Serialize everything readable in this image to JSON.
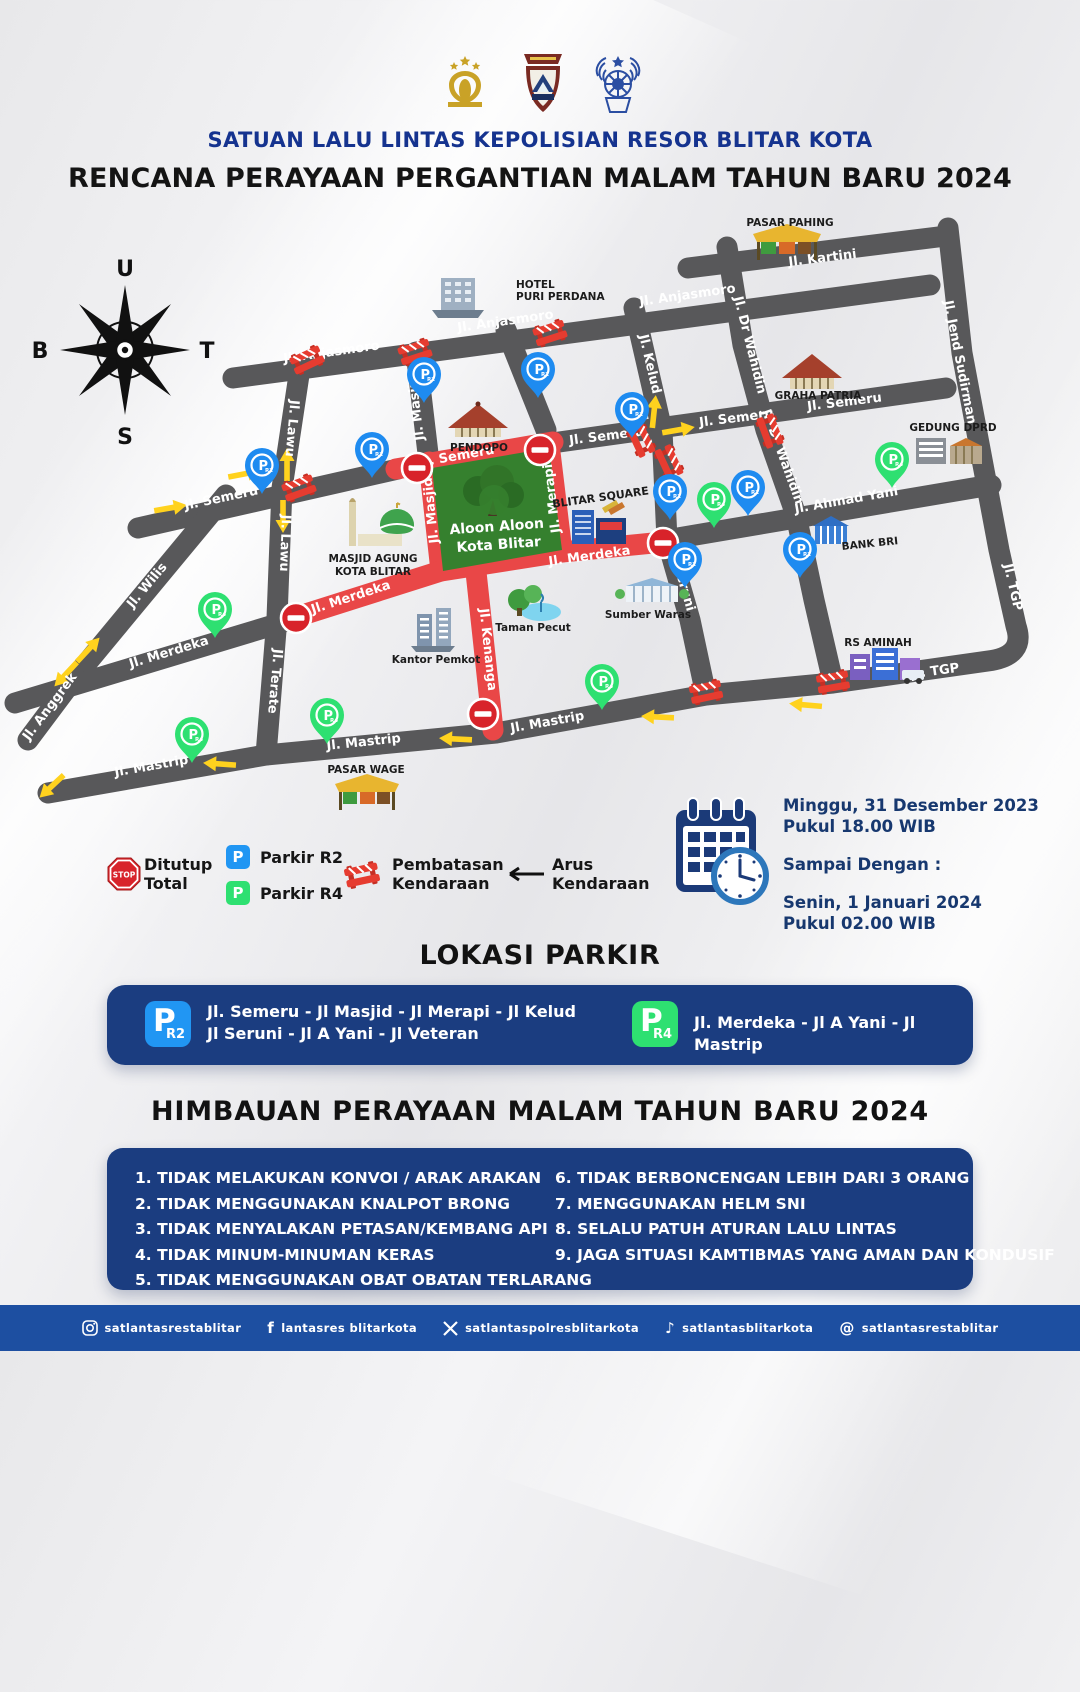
{
  "header": {
    "org": "SATUAN LALU LINTAS KEPOLISIAN RESOR BLITAR KOTA",
    "title": "RENCANA PERAYAAN PERGANTIAN MALAM TAHUN BARU 2024"
  },
  "compass": {
    "u": "U",
    "t": "T",
    "s": "S",
    "b": "B"
  },
  "map": {
    "road_labels": [
      "Jl. Kartini",
      "Jl. Anjasmoro",
      "Jl. Anjasmoro",
      "Jl. Anjasmoro",
      "Jl. Jend Sudirman",
      "Jl. Dr Wahidin",
      "Jl. Dr Wahidin",
      "Jl. Kelud",
      "Jl. Semeru",
      "Jl. Semeru",
      "Jl. Semeru",
      "Jl. Semeru",
      "Jl. Semeru",
      "Jl. Lawu",
      "Jl. Lawu",
      "Jl. Wilis",
      "Jl. Anggrek",
      "Jl. Terate",
      "Jl. Merdeka",
      "Jl. Merdeka",
      "Jl. Merdeka",
      "Jl. Masjid",
      "Jl. Masjid",
      "Jl. Merapi",
      "Jl. Kenanga",
      "Jl. Seruni",
      "Jl. Ahmad Yani",
      "Jl. Mastrip",
      "Jl. Mastrip",
      "Jl. Mastrip",
      "Jl. TGP",
      "Jl. TGP"
    ],
    "landmarks": [
      {
        "l1": "PASAR PAHING"
      },
      {
        "l1": "HOTEL",
        "l2": "PURI PERDANA"
      },
      {
        "l1": "GRAHA PATRIA"
      },
      {
        "l1": "GEDUNG DPRD"
      },
      {
        "l1": "PENDOPO"
      },
      {
        "l1": "MASJID AGUNG",
        "l2": "KOTA BLITAR"
      },
      {
        "l1": "BLITAR SQUARE"
      },
      {
        "l1": "Taman Pecut"
      },
      {
        "l1": "Kantor Pemkot"
      },
      {
        "l1": "Sumber Waras"
      },
      {
        "l1": "BANK BRI"
      },
      {
        "l1": "RS AMINAH"
      },
      {
        "l1": "PASAR WAGE"
      }
    ],
    "square": {
      "l1": "Aloon Aloon",
      "l2": "Kota Blitar"
    },
    "pins": {
      "p": "P",
      "r2": "R2",
      "r4": "R4"
    },
    "colors": {
      "road": "#58585a",
      "closed_road": "#e94747",
      "square_green": "#35802e",
      "pin_blue": "#1e8bf0",
      "pin_green": "#2ee071",
      "barrier_red": "#e63c30"
    }
  },
  "legend": {
    "closed1": "Ditutup",
    "closed2": "Total",
    "stop": "STOP",
    "p": "P",
    "r2": "Parkir R2",
    "r4": "Parkir R4",
    "restr1": "Pembatasan",
    "restr2": "Kendaraan",
    "flow1": "Arus",
    "flow2": "Kendaraan"
  },
  "schedule": {
    "start_date": "Minggu, 31 Desember 2023",
    "start_time": "Pukul 18.00 WIB",
    "until": "Sampai Dengan :",
    "end_date": "Senin, 1 Januari 2024",
    "end_time": "Pukul 02.00 WIB"
  },
  "parking": {
    "title": "LOKASI PARKIR",
    "r2_badge_p": "P",
    "r2_badge_sub": "R2",
    "r2_line1": "Jl. Semeru - Jl Masjid - Jl Merapi - Jl Kelud",
    "r2_line2": "Jl Seruni - Jl A Yani - Jl Veteran",
    "r4_badge_p": "P",
    "r4_badge_sub": "R4",
    "r4_line1": "Jl. Merdeka - Jl A Yani - Jl Mastrip"
  },
  "advisory": {
    "title": "HIMBAUAN PERAYAAN MALAM TAHUN BARU 2024",
    "col1": [
      "1. TIDAK MELAKUKAN KONVOI / ARAK ARAKAN",
      "2. TIDAK MENGGUNAKAN KNALPOT BRONG",
      "3. TIDAK MENYALAKAN PETASAN/KEMBANG API",
      "4. TIDAK MINUM-MINUMAN KERAS",
      "5. TIDAK MENGGUNAKAN OBAT OBATAN TERLARANG"
    ],
    "col2": [
      "6. TIDAK BERBONCENGAN LEBIH DARI 3 ORANG",
      "7. MENGGUNAKAN HELM SNI",
      "8. SELALU PATUH ATURAN LALU LINTAS",
      "9. JAGA SITUASI KAMTIBMAS YANG AMAN DAN KONDUSIF"
    ]
  },
  "footer": {
    "handles": [
      {
        "icon": "instagram",
        "h": "satlantasrestablitar"
      },
      {
        "icon": "facebook",
        "h": "lantasres blitarkota"
      },
      {
        "icon": "x",
        "h": "satlantaspolresblitarkota"
      },
      {
        "icon": "tiktok",
        "h": "satlantasblitarkota"
      },
      {
        "icon": "threads",
        "h": "satlantasrestablitar"
      }
    ]
  }
}
